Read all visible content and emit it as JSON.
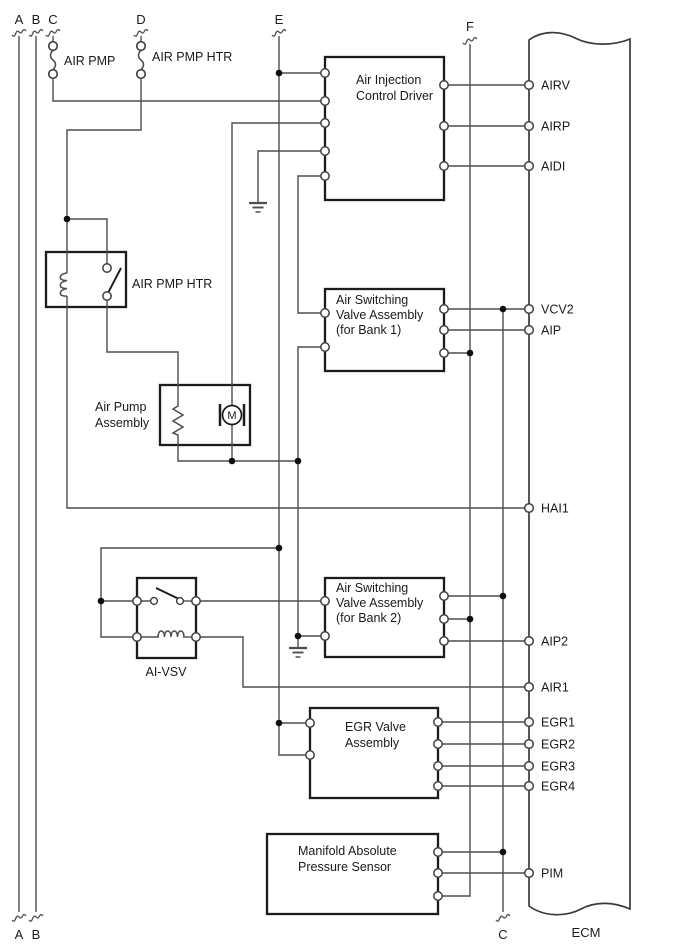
{
  "canvas": {
    "w": 688,
    "h": 949,
    "bg": "#ffffff"
  },
  "colors": {
    "wire": "#4e4e52",
    "box_border": "#1c1c1c",
    "ecm_border": "#3a3a3e",
    "text": "#1a1a1a",
    "dot": "#0e0e0e",
    "terminal_stroke": "#3f3f44",
    "terminal_fill": "#ffffff"
  },
  "top_connectors": [
    {
      "label": "A",
      "x": 19,
      "label_y": 24,
      "break_y": 33
    },
    {
      "label": "B",
      "x": 36,
      "label_y": 24,
      "break_y": 33
    },
    {
      "label": "C",
      "x": 53,
      "label_y": 24,
      "break_y": 33
    },
    {
      "label": "D",
      "x": 141,
      "label_y": 24,
      "break_y": 33
    },
    {
      "label": "E",
      "x": 279,
      "label_y": 24,
      "break_y": 33
    },
    {
      "label": "F",
      "x": 470,
      "label_y": 31,
      "break_y": 41
    }
  ],
  "bottom_connectors": [
    {
      "label": "A",
      "x": 19,
      "label_y": 939,
      "break_y": 918
    },
    {
      "label": "B",
      "x": 36,
      "label_y": 939,
      "break_y": 918
    },
    {
      "label": "C",
      "x": 503,
      "label_y": 939,
      "break_y": 918
    }
  ],
  "fuses": [
    {
      "name": "fuse-air-pmp",
      "label": "AIR PMP",
      "x": 53,
      "cy1": 46,
      "cy2": 74,
      "label_x": 64,
      "label_y": 65
    },
    {
      "name": "fuse-air-pmp-htr",
      "label": "AIR PMP HTR",
      "x": 141,
      "cy1": 46,
      "cy2": 74,
      "label_x": 152,
      "label_y": 61
    }
  ],
  "components": [
    {
      "id": "air-injection-control-driver",
      "box": [
        325,
        57,
        119,
        143
      ],
      "lines": [
        "Air Injection",
        "Control Driver"
      ],
      "text_x": 356,
      "text_y": 84,
      "line_h": 16
    },
    {
      "id": "air-switching-valve-bank1",
      "box": [
        325,
        289,
        119,
        82
      ],
      "lines": [
        "Air Switching",
        "Valve Assembly",
        "(for Bank 1)"
      ],
      "text_x": 336,
      "text_y": 304,
      "line_h": 15
    },
    {
      "id": "air-switching-valve-bank2",
      "box": [
        325,
        578,
        119,
        79
      ],
      "lines": [
        "Air Switching",
        "Valve Assembly",
        "(for Bank 2)"
      ],
      "text_x": 336,
      "text_y": 592,
      "line_h": 15
    },
    {
      "id": "egr-valve-assembly",
      "box": [
        310,
        708,
        128,
        90
      ],
      "lines": [
        "EGR Valve",
        "Assembly"
      ],
      "text_x": 345,
      "text_y": 731,
      "line_h": 16
    },
    {
      "id": "manifold-absolute-pressure-sensor",
      "box": [
        267,
        834,
        171,
        80
      ],
      "lines": [
        "Manifold Absolute",
        "Pressure Sensor"
      ],
      "text_x": 298,
      "text_y": 855,
      "line_h": 16
    },
    {
      "id": "air-pump-assembly",
      "box": [
        160,
        385,
        90,
        60
      ],
      "lines": [],
      "ext_label": {
        "lines": [
          "Air Pump",
          "Assembly"
        ],
        "x": 95,
        "y": 411,
        "line_h": 16,
        "anchor": "start"
      }
    },
    {
      "id": "air-pmp-htr-relay",
      "box": [
        46,
        252,
        80,
        55
      ],
      "lines": [],
      "ext_label": {
        "lines": [
          "AIR PMP HTR"
        ],
        "x": 132,
        "y": 288,
        "line_h": 16,
        "anchor": "start"
      }
    },
    {
      "id": "ai-vsv",
      "box": [
        137,
        578,
        59,
        80
      ],
      "lines": [],
      "ext_label": {
        "lines": [
          "AI-VSV"
        ],
        "x": 166,
        "y": 676,
        "line_h": 16,
        "anchor": "middle"
      }
    }
  ],
  "ecm": {
    "label": "ECM",
    "label_x": 586,
    "label_y": 937,
    "x1": 529,
    "x2": 630,
    "top_y": 40,
    "bottom_y": 906,
    "pins": [
      {
        "name": "AIRV",
        "y": 85
      },
      {
        "name": "AIRP",
        "y": 126
      },
      {
        "name": "AIDI",
        "y": 166
      },
      {
        "name": "VCV2",
        "y": 309
      },
      {
        "name": "AIP",
        "y": 330
      },
      {
        "name": "HAI1",
        "y": 508
      },
      {
        "name": "AIP2",
        "y": 641
      },
      {
        "name": "AIR1",
        "y": 687
      },
      {
        "name": "EGR1",
        "y": 722
      },
      {
        "name": "EGR2",
        "y": 744
      },
      {
        "name": "EGR3",
        "y": 766
      },
      {
        "name": "EGR4",
        "y": 786
      },
      {
        "name": "PIM",
        "y": 873
      }
    ],
    "pin_label_x": 541
  },
  "wires": [
    [
      [
        19,
        36
      ],
      [
        19,
        912
      ]
    ],
    [
      [
        36,
        36
      ],
      [
        36,
        912
      ]
    ],
    [
      [
        53,
        36
      ],
      [
        53,
        43
      ]
    ],
    [
      [
        53,
        77
      ],
      [
        53,
        101
      ],
      [
        325,
        101
      ]
    ],
    [
      [
        141,
        36
      ],
      [
        141,
        43
      ]
    ],
    [
      [
        141,
        77
      ],
      [
        141,
        130
      ],
      [
        67,
        130
      ],
      [
        67,
        273
      ]
    ],
    [
      [
        67,
        296
      ],
      [
        67,
        508
      ],
      [
        529,
        508
      ]
    ],
    [
      [
        67,
        219
      ],
      [
        107,
        219
      ],
      [
        107,
        268
      ]
    ],
    [
      [
        107,
        296
      ],
      [
        107,
        352
      ],
      [
        178,
        352
      ],
      [
        178,
        403
      ]
    ],
    [
      [
        178,
        437
      ],
      [
        178,
        461
      ],
      [
        298,
        461
      ]
    ],
    [
      [
        325,
        123
      ],
      [
        232,
        123
      ],
      [
        232,
        406
      ]
    ],
    [
      [
        232,
        425
      ],
      [
        232,
        461
      ]
    ],
    [
      [
        325,
        151
      ],
      [
        258,
        151
      ],
      [
        258,
        202
      ]
    ],
    [
      [
        325,
        176
      ],
      [
        298,
        176
      ],
      [
        298,
        313
      ],
      [
        325,
        313
      ]
    ],
    [
      [
        325,
        347
      ],
      [
        298,
        347
      ],
      [
        298,
        647
      ]
    ],
    [
      [
        279,
        36
      ],
      [
        279,
        723
      ]
    ],
    [
      [
        279,
        73
      ],
      [
        325,
        73
      ]
    ],
    [
      [
        279,
        548
      ],
      [
        101,
        548
      ],
      [
        101,
        637
      ],
      [
        137,
        637
      ]
    ],
    [
      [
        101,
        601
      ],
      [
        137,
        601
      ]
    ],
    [
      [
        154,
        601
      ],
      [
        137,
        601
      ]
    ],
    [
      [
        180,
        601
      ],
      [
        196,
        601
      ]
    ],
    [
      [
        196,
        601
      ],
      [
        325,
        601
      ]
    ],
    [
      [
        137,
        637
      ],
      [
        159,
        637
      ]
    ],
    [
      [
        183,
        637
      ],
      [
        196,
        637
      ]
    ],
    [
      [
        196,
        637
      ],
      [
        243,
        637
      ],
      [
        243,
        687
      ],
      [
        529,
        687
      ]
    ],
    [
      [
        279,
        723
      ],
      [
        310,
        723
      ]
    ],
    [
      [
        279,
        723
      ],
      [
        279,
        755
      ],
      [
        310,
        755
      ]
    ],
    [
      [
        444,
        85
      ],
      [
        529,
        85
      ]
    ],
    [
      [
        444,
        126
      ],
      [
        529,
        126
      ]
    ],
    [
      [
        444,
        166
      ],
      [
        529,
        166
      ]
    ],
    [
      [
        444,
        309
      ],
      [
        529,
        309
      ]
    ],
    [
      [
        503,
        309
      ],
      [
        503,
        912
      ]
    ],
    [
      [
        444,
        330
      ],
      [
        529,
        330
      ]
    ],
    [
      [
        444,
        353
      ],
      [
        470,
        353
      ]
    ],
    [
      [
        470,
        44
      ],
      [
        470,
        896
      ],
      [
        438,
        896
      ]
    ],
    [
      [
        444,
        596
      ],
      [
        503,
        596
      ]
    ],
    [
      [
        444,
        619
      ],
      [
        470,
        619
      ]
    ],
    [
      [
        444,
        641
      ],
      [
        529,
        641
      ]
    ],
    [
      [
        298,
        636
      ],
      [
        325,
        636
      ]
    ],
    [
      [
        438,
        722
      ],
      [
        529,
        722
      ]
    ],
    [
      [
        438,
        744
      ],
      [
        529,
        744
      ]
    ],
    [
      [
        438,
        766
      ],
      [
        529,
        766
      ]
    ],
    [
      [
        438,
        786
      ],
      [
        529,
        786
      ]
    ],
    [
      [
        438,
        852
      ],
      [
        503,
        852
      ]
    ],
    [
      [
        438,
        873
      ],
      [
        529,
        873
      ]
    ]
  ],
  "terminals": [
    [
      325,
      73
    ],
    [
      325,
      101
    ],
    [
      325,
      123
    ],
    [
      325,
      151
    ],
    [
      325,
      176
    ],
    [
      444,
      85
    ],
    [
      444,
      126
    ],
    [
      444,
      166
    ],
    [
      325,
      313
    ],
    [
      325,
      347
    ],
    [
      444,
      309
    ],
    [
      444,
      330
    ],
    [
      444,
      353
    ],
    [
      325,
      601
    ],
    [
      325,
      636
    ],
    [
      444,
      596
    ],
    [
      444,
      619
    ],
    [
      444,
      641
    ],
    [
      310,
      723
    ],
    [
      310,
      755
    ],
    [
      438,
      722
    ],
    [
      438,
      744
    ],
    [
      438,
      766
    ],
    [
      438,
      786
    ],
    [
      438,
      852
    ],
    [
      438,
      873
    ],
    [
      438,
      896
    ],
    [
      107,
      268
    ],
    [
      107,
      296
    ],
    [
      137,
      601
    ],
    [
      196,
      601
    ],
    [
      137,
      637
    ],
    [
      196,
      637
    ],
    [
      53,
      46
    ],
    [
      53,
      74
    ],
    [
      141,
      46
    ],
    [
      141,
      74
    ]
  ],
  "inner_circles": [
    [
      154,
      601
    ],
    [
      180,
      601
    ]
  ],
  "dots": [
    [
      279,
      73
    ],
    [
      67,
      219
    ],
    [
      503,
      309
    ],
    [
      470,
      353
    ],
    [
      232,
      461
    ],
    [
      298,
      461
    ],
    [
      279,
      548
    ],
    [
      503,
      596
    ],
    [
      101,
      601
    ],
    [
      470,
      619
    ],
    [
      298,
      636
    ],
    [
      279,
      723
    ],
    [
      503,
      852
    ]
  ],
  "grounds": [
    [
      258,
      203
    ],
    [
      298,
      648
    ]
  ],
  "resistor": {
    "x": 178,
    "y1": 403,
    "y2": 437
  },
  "motor": {
    "cx": 232,
    "cy": 415,
    "r": 9.5,
    "label": "M",
    "bar_dx": 12,
    "bar_h": 22
  },
  "relay_coil": {
    "x": 67,
    "y1": 273,
    "y2": 296
  },
  "aivsv_coil": {
    "x1": 158,
    "x2": 184,
    "y": 637
  },
  "blades": [
    [
      108,
      293,
      121,
      268
    ],
    [
      156,
      588,
      179,
      599
    ]
  ]
}
